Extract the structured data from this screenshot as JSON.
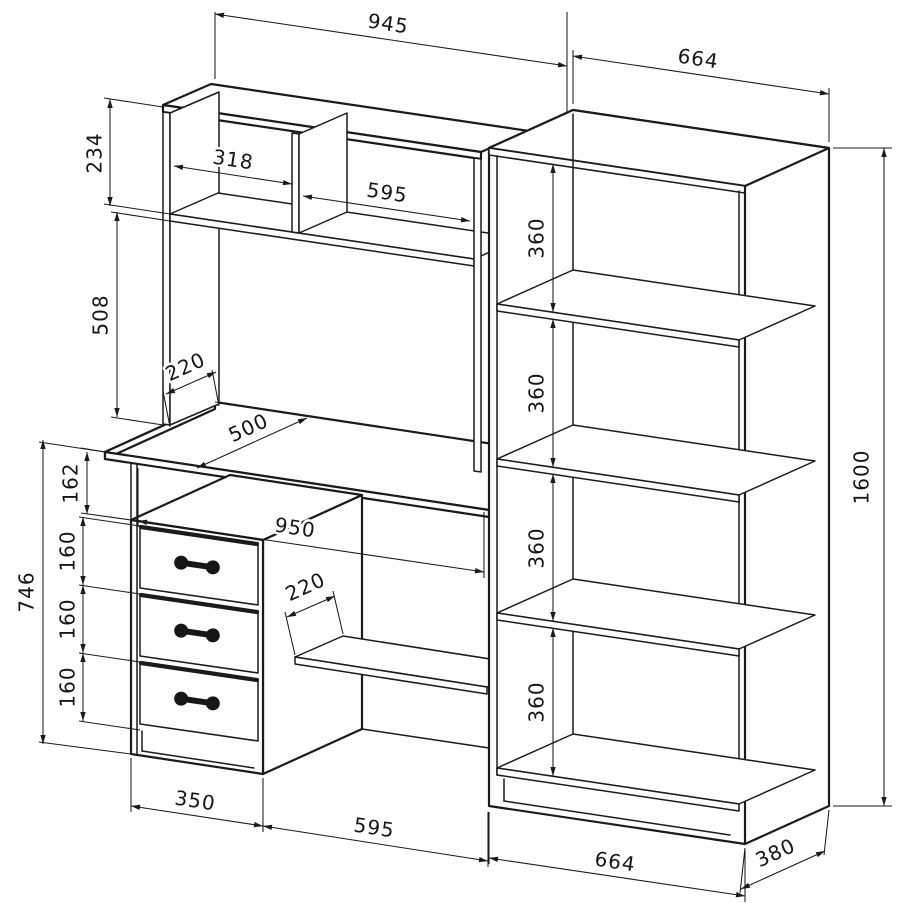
{
  "drawing": {
    "kind": "furniture technical drawing",
    "subject": "computer desk with hutch and drawer pedestal, plus tall bookshelf",
    "background_color": "#ffffff",
    "line_color": "#1b1b1b"
  },
  "dims": [
    {
      "v": "945",
      "line": [
        215,
        14,
        567,
        66
      ],
      "label": [
        388,
        25
      ],
      "rot": 8.4,
      "exts": []
    },
    {
      "v": "664",
      "line": [
        573,
        56,
        829,
        94
      ],
      "label": [
        698,
        60
      ],
      "rot": 8.4,
      "exts": [
        [
          573,
          104,
          573,
          50
        ],
        [
          829,
          142,
          829,
          88
        ]
      ]
    },
    {
      "v": "234",
      "line": [
        110,
        99,
        110,
        206
      ],
      "label": [
        96,
        153
      ],
      "rot": -90,
      "exts": [
        [
          163,
          107,
          104,
          98
        ],
        [
          170,
          214,
          104,
          204
        ]
      ]
    },
    {
      "v": "318",
      "line": [
        174,
        166,
        292,
        184
      ],
      "label": [
        233,
        161
      ],
      "rot": 8.4,
      "exts": []
    },
    {
      "v": "595",
      "line": [
        303,
        196,
        470,
        221
      ],
      "label": [
        387,
        194
      ],
      "rot": 8.4,
      "exts": []
    },
    {
      "v": "508",
      "line": [
        117,
        212,
        117,
        417
      ],
      "label": [
        102,
        315
      ],
      "rot": -90,
      "exts": [
        [
          170,
          221,
          111,
          212
        ],
        [
          163,
          425,
          111,
          417
        ]
      ]
    },
    {
      "v": "220",
      "line": [
        166,
        394,
        216,
        372
      ],
      "label": [
        186,
        368
      ],
      "rot": -24.4,
      "exts": [
        [
          170,
          427,
          163,
          391
        ],
        [
          219,
          406,
          212,
          370
        ]
      ]
    },
    {
      "v": "500",
      "line": [
        197,
        468,
        307,
        418
      ],
      "label": [
        249,
        429
      ],
      "rot": -24.4,
      "exts": [
        [
          105,
          452,
          203,
          467
        ],
        [
          215,
          402,
          313,
          417
        ]
      ]
    },
    {
      "v": "162",
      "line": [
        87,
        452,
        87,
        514
      ],
      "label": [
        72,
        483
      ],
      "rot": -90,
      "exts": [
        [
          105,
          452,
          81,
          448
        ],
        [
          131,
          520,
          81,
          513
        ]
      ]
    },
    {
      "v": "950",
      "line": [
        138,
        521,
        484,
        572
      ],
      "label": [
        295,
        529
      ],
      "rot": 8.4,
      "exts": [
        [
          138,
          527,
          138,
          468
        ],
        [
          484,
          578,
          484,
          512
        ]
      ]
    },
    {
      "v": "746",
      "line": [
        43,
        440,
        43,
        744
      ],
      "label": [
        28,
        592
      ],
      "rot": -90,
      "exts": [
        [
          105,
          452,
          39,
          442
        ],
        [
          131,
          754,
          39,
          742
        ]
      ]
    },
    {
      "v": "160",
      "line": [
        83,
        517,
        83,
        585
      ],
      "label": [
        69,
        551
      ],
      "rot": -90,
      "exts": [
        [
          140,
          526,
          79,
          517
        ],
        [
          140,
          594,
          79,
          585
        ]
      ]
    },
    {
      "v": "160",
      "line": [
        83,
        585,
        83,
        653
      ],
      "label": [
        69,
        619
      ],
      "rot": -90,
      "exts": [
        [
          140,
          662,
          79,
          653
        ]
      ]
    },
    {
      "v": "160",
      "line": [
        83,
        653,
        83,
        721
      ],
      "label": [
        69,
        687
      ],
      "rot": -90,
      "exts": [
        [
          140,
          730,
          79,
          721
        ]
      ]
    },
    {
      "v": "220",
      "line": [
        287,
        617,
        335,
        596
      ],
      "label": [
        306,
        588
      ],
      "rot": -24.4,
      "exts": [
        [
          295,
          655,
          285,
          612
        ],
        [
          343,
          634,
          333,
          591
        ]
      ]
    },
    {
      "v": "360",
      "line": [
        553,
        164,
        553,
        312
      ],
      "label": [
        538,
        238
      ],
      "rot": -90,
      "exts": []
    },
    {
      "v": "360",
      "line": [
        553,
        319,
        553,
        467
      ],
      "label": [
        538,
        393
      ],
      "rot": -90,
      "exts": []
    },
    {
      "v": "360",
      "line": [
        553,
        474,
        553,
        621
      ],
      "label": [
        538,
        548
      ],
      "rot": -90,
      "exts": []
    },
    {
      "v": "360",
      "line": [
        553,
        628,
        553,
        776
      ],
      "label": [
        538,
        702
      ],
      "rot": -90,
      "exts": []
    },
    {
      "v": "1600",
      "line": [
        884,
        148,
        884,
        806
      ],
      "label": [
        863,
        477
      ],
      "rot": -90,
      "exts": [
        [
          833,
          148,
          892,
          148
        ],
        [
          833,
          806,
          892,
          806
        ]
      ]
    },
    {
      "v": "350",
      "line": [
        131,
        806,
        263,
        826
      ],
      "label": [
        195,
        802
      ],
      "rot": 8.4,
      "exts": [
        [
          131,
          758,
          131,
          812
        ],
        [
          263,
          778,
          263,
          832
        ]
      ]
    },
    {
      "v": "595",
      "line": [
        263,
        826,
        488,
        861
      ],
      "label": [
        374,
        829
      ],
      "rot": 8.4,
      "exts": [
        [
          488,
          812,
          488,
          867
        ]
      ]
    },
    {
      "v": "664",
      "line": [
        489,
        858,
        745,
        896
      ],
      "label": [
        615,
        863
      ],
      "rot": 8.4,
      "exts": [
        [
          489,
          812,
          489,
          864
        ],
        [
          745,
          850,
          745,
          902
        ]
      ]
    },
    {
      "v": "380",
      "line": [
        741,
        889,
        825,
        851
      ],
      "label": [
        776,
        854
      ],
      "rot": -24.4,
      "exts": [
        [
          745,
          848,
          740,
          893
        ],
        [
          829,
          810,
          824,
          855
        ]
      ]
    }
  ]
}
